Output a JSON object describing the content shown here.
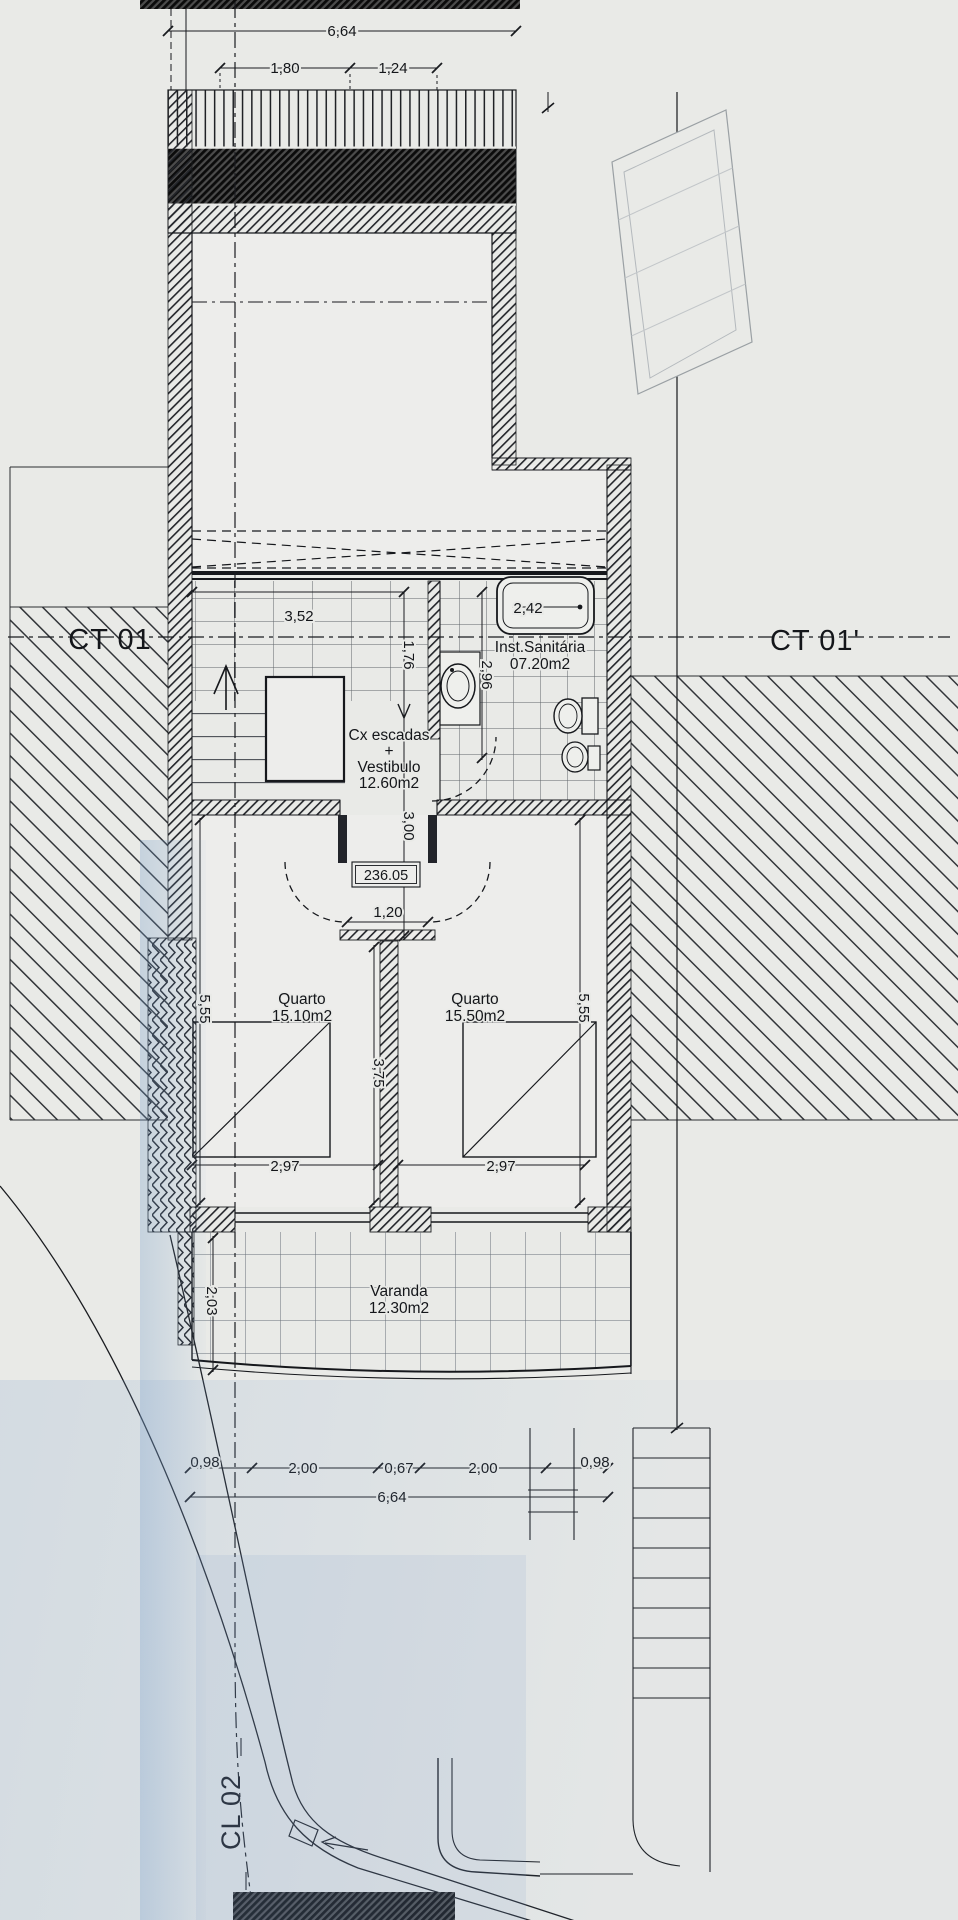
{
  "drawing": {
    "markers": {
      "ct_left": "CT 01",
      "ct_right": "CT 01'",
      "cl_bottom": "CL 02"
    },
    "rooms": {
      "bathroom": {
        "name": "Inst.Sanitária",
        "area": "07.20m2"
      },
      "stairwell": {
        "line1": "Cx escadas",
        "line2": "+",
        "line3": "Vestibulo",
        "area": "12.60m2"
      },
      "bedroom_left": {
        "name": "Quarto",
        "area": "15.10m2"
      },
      "bedroom_right": {
        "name": "Quarto",
        "area": "15.50m2"
      },
      "balcony": {
        "name": "Varanda",
        "area": "12.30m2"
      }
    },
    "level_mark": "236.05",
    "dims": {
      "top_total": "6,64",
      "top_a": "1,80",
      "top_b": "1,24",
      "stair_w": "3,52",
      "stair_d": "1,76",
      "bath_d": "2,96",
      "tub": "2,42",
      "vest_d": "3,00",
      "door": "1,20",
      "room_d_left": "5,55",
      "room_d_right": "5,55",
      "mid": "3,75",
      "win_left": "2,97",
      "win_right": "2,97",
      "balc_d": "2,03",
      "bot_a": "0,98",
      "bot_b": "2,00",
      "bot_c": "0,67",
      "bot_d": "2,00",
      "bot_e": "0,98",
      "bot_total": "6,64"
    }
  }
}
